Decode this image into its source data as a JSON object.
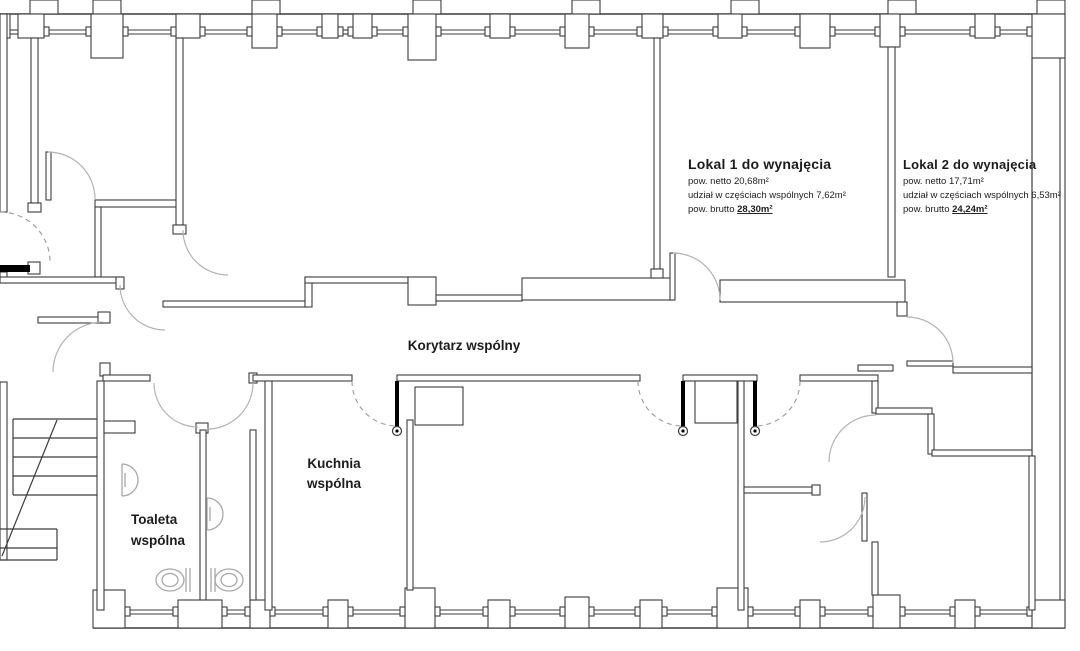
{
  "document": {
    "type": "floor-plan",
    "language": "pl"
  },
  "colors": {
    "wall": "#3c3c3c",
    "door_arc": "#b3b3b3",
    "dashed_swing": "#9a9a9a",
    "text": "#1c1c1c",
    "background": "#ffffff",
    "fixtures": "#a8a8a8"
  },
  "rooms": {
    "lokal1": {
      "title": "Lokal 1 do wynajęcia",
      "area_net": "pow. netto 20,68m²",
      "share_common": "udział w częściach wspólnych 7,62m²",
      "area_gross_prefix": "pow. brutto ",
      "area_gross_value": "28,30m²"
    },
    "lokal2": {
      "title": "Lokal 2 do wynajęcia",
      "area_net": "pow. netto 17,71m²",
      "share_common": "udział w częściach wspólnych 6,53m²",
      "area_gross_prefix": "pow. brutto ",
      "area_gross_value": "24,24m²"
    },
    "corridor": {
      "label": "Korytarz wspólny"
    },
    "kitchen": {
      "label_line1": "Kuchnia",
      "label_line2": "wspólna"
    },
    "toilet": {
      "label_line1": "Toaleta",
      "label_line2": "wspólna"
    }
  }
}
